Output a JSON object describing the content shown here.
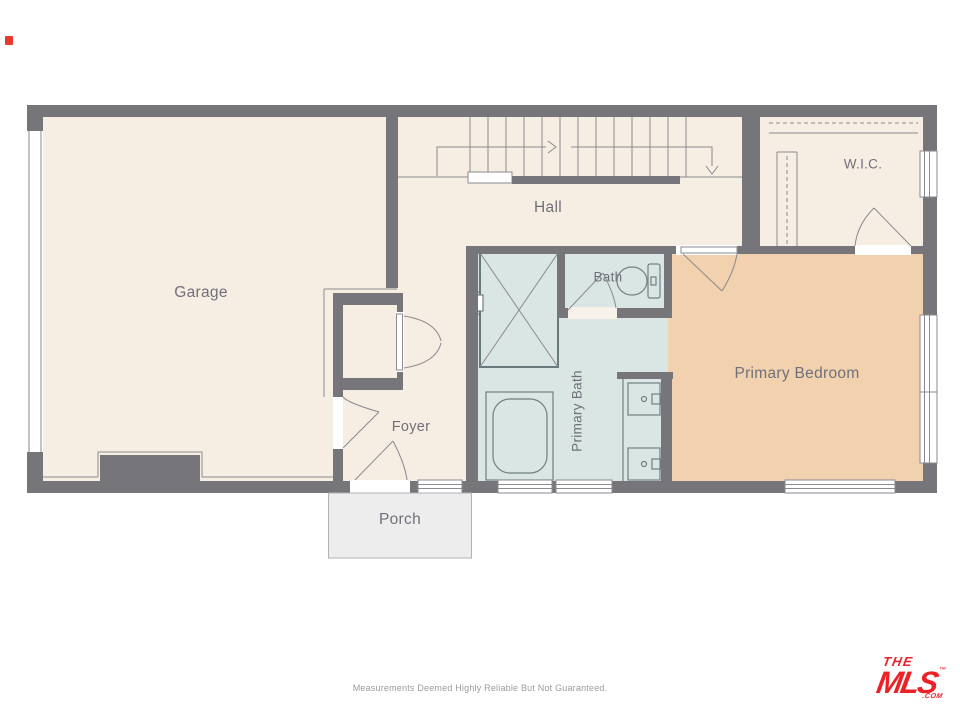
{
  "rooms": {
    "garage": {
      "label": "Garage"
    },
    "hall": {
      "label": "Hall"
    },
    "wic": {
      "label": "W.I.C."
    },
    "bath": {
      "label": "Bath"
    },
    "primary_bath": {
      "label": "Primary Bath"
    },
    "primary_bedroom": {
      "label": "Primary Bedroom"
    },
    "foyer": {
      "label": "Foyer"
    },
    "porch": {
      "label": "Porch"
    }
  },
  "footer": {
    "disclaimer": "Measurements Deemed Highly Reliable But Not Guaranteed."
  },
  "logo": {
    "line1": "THE",
    "line2": "MLS",
    "trademark": "™",
    "suffix": ".COM"
  },
  "colors": {
    "wall": "#75757a",
    "floor": "#f6ede3",
    "bath": "#d9e6e4",
    "bedroom": "#f1d1ae",
    "porch": "#ededee",
    "line": "#8a8a90",
    "fixture": "#6f8082",
    "label": "#70707a",
    "red": "#ec2127",
    "marker": "#e8392e",
    "disclaimer": "#9b9b9b"
  }
}
